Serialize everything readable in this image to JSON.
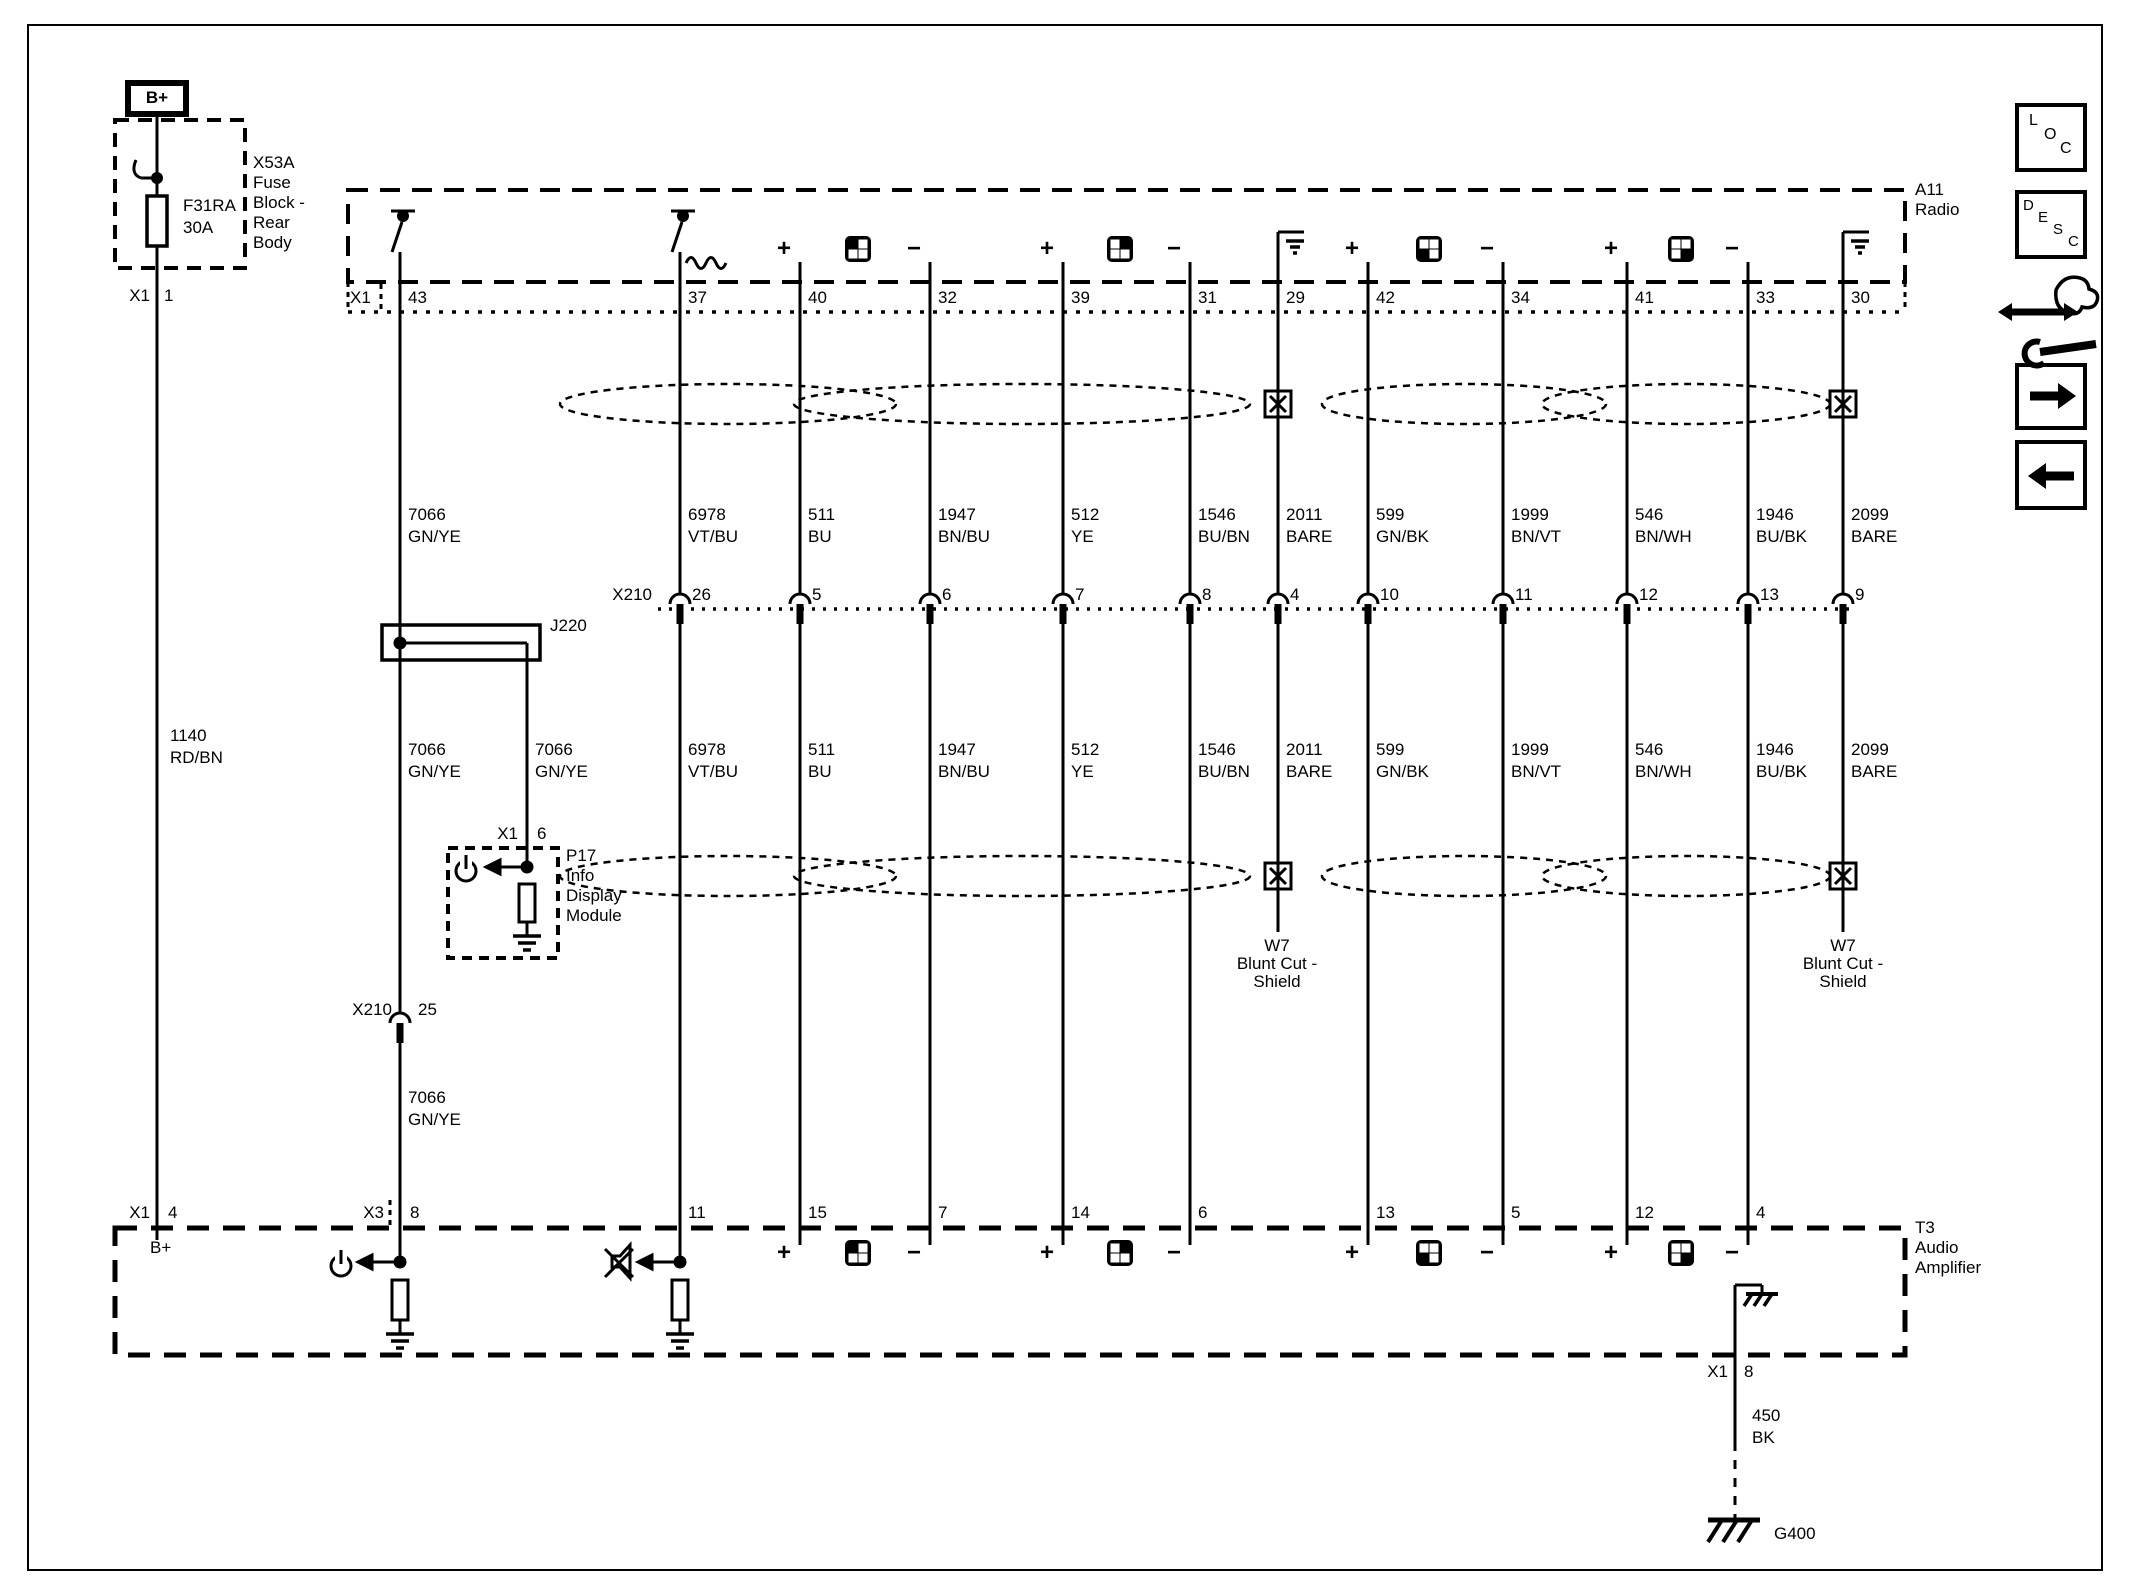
{
  "fuse_block": {
    "terminal": "B+",
    "fuse_id": "F31RA",
    "fuse_rating": "30A",
    "name_lines": [
      "X53A",
      "Fuse",
      "Block -",
      "Rear",
      "Body"
    ],
    "connector": "X1",
    "pin": "1"
  },
  "power_wire": {
    "c": "1140",
    "col": "RD/BN"
  },
  "radio": {
    "id": "A11",
    "name": "Radio",
    "connector": "X1",
    "pins": [
      "43",
      "37",
      "40",
      "32",
      "39",
      "31",
      "29",
      "42",
      "34",
      "41",
      "33",
      "30"
    ]
  },
  "signs": {
    "plus": "+",
    "minus": "−"
  },
  "wires_row1": [
    {
      "c": "7066",
      "col": "GN/YE"
    },
    {
      "c": "6978",
      "col": "VT/BU"
    },
    {
      "c": "511",
      "col": "BU"
    },
    {
      "c": "1947",
      "col": "BN/BU"
    },
    {
      "c": "512",
      "col": "YE"
    },
    {
      "c": "1546",
      "col": "BU/BN"
    },
    {
      "c": "2011",
      "col": "BARE"
    },
    {
      "c": "599",
      "col": "GN/BK"
    },
    {
      "c": "1999",
      "col": "BN/VT"
    },
    {
      "c": "546",
      "col": "BN/WH"
    },
    {
      "c": "1946",
      "col": "BU/BK"
    },
    {
      "c": "2099",
      "col": "BARE"
    }
  ],
  "branch_wire": {
    "c": "7066",
    "col": "GN/YE"
  },
  "wire_row3": {
    "c": "7066",
    "col": "GN/YE"
  },
  "x210": {
    "label": "X210",
    "pins": [
      "26",
      "5",
      "6",
      "7",
      "8",
      "4",
      "10",
      "11",
      "12",
      "13",
      "9"
    ],
    "pin25": "25"
  },
  "j220": {
    "label": "J220"
  },
  "p17": {
    "connector": "X1",
    "pin": "6",
    "name_lines": [
      "P17",
      "Info",
      "Display",
      "Module"
    ]
  },
  "w7": {
    "lines": [
      "W7",
      "Blunt Cut -",
      "Shield"
    ]
  },
  "amp": {
    "id": "T3",
    "name_lines": [
      "Audio",
      "Amplifier"
    ],
    "bplus": "B+",
    "conn1": "X1",
    "pin1": "4",
    "conn3": "X3",
    "pin3": "8",
    "pins": [
      "11",
      "15",
      "7",
      "14",
      "6",
      "13",
      "5",
      "12",
      "4"
    ],
    "gnd_connector": "X1",
    "gnd_pin": "8"
  },
  "gnd_wire": {
    "c": "450",
    "col": "BK"
  },
  "g400": {
    "label": "G400"
  },
  "toolbar": {
    "loc": [
      "L",
      "O",
      "C"
    ],
    "desc": [
      "D",
      "E",
      "S",
      "C"
    ]
  }
}
